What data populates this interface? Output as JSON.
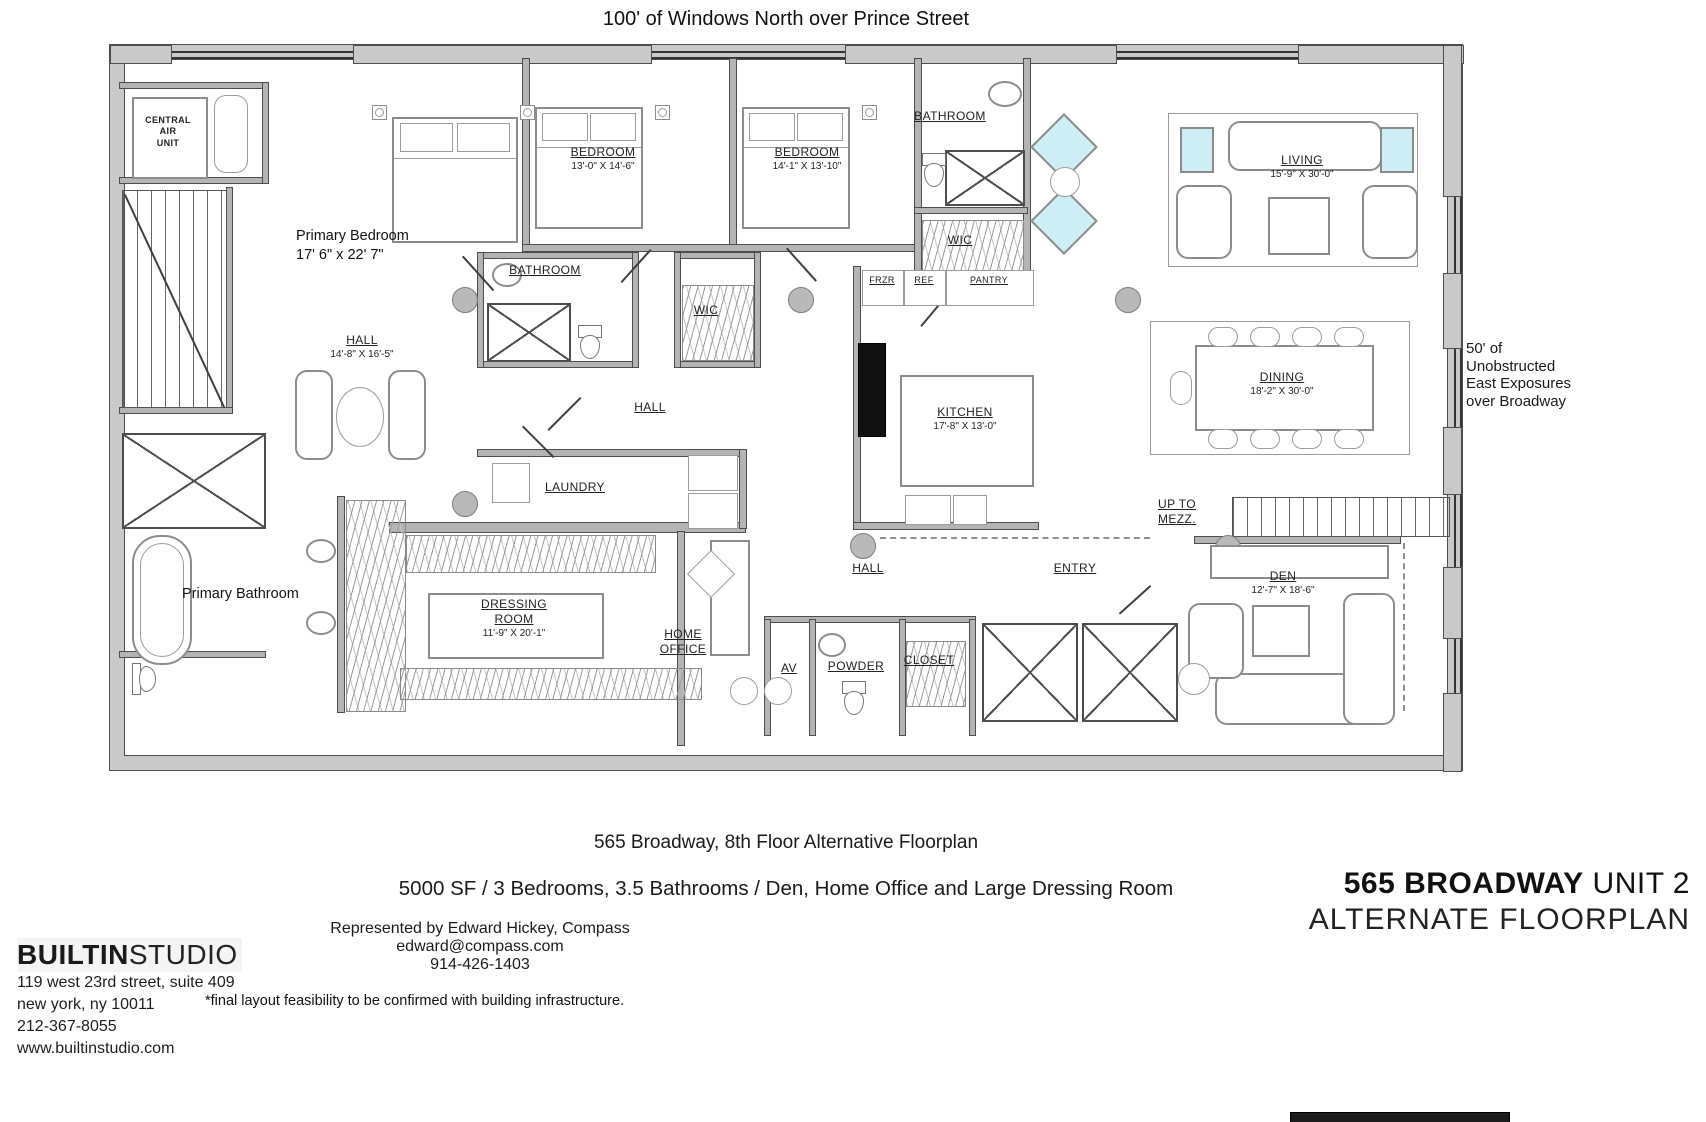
{
  "plan": {
    "title": "100' of Windows North over Prince Street",
    "side_note": "50' of Unobstructed East Exposures over Broadway"
  },
  "rooms": {
    "central_air": {
      "name": "CENTRAL\nAIR\nUNIT"
    },
    "primary_bedroom": {
      "name": "Primary Bedroom",
      "dims": "17' 6\" x 22' 7\""
    },
    "bedroom_2": {
      "name": "BEDROOM",
      "dims": "13'-0\" X 14'-6\""
    },
    "bedroom_3": {
      "name": "BEDROOM",
      "dims": "14'-1\" X 13'-10\""
    },
    "bathroom_hall": {
      "name": "BATHROOM"
    },
    "bathroom_top": {
      "name": "BATHROOM"
    },
    "wic_hall": {
      "name": "WIC"
    },
    "wic_top": {
      "name": "WIC"
    },
    "hall_primary": {
      "name": "HALL",
      "dims": "14'-8\" X 16'-5\""
    },
    "hall_center": {
      "name": "HALL"
    },
    "hall_rear": {
      "name": "HALL"
    },
    "frzr": {
      "name": "FRZR"
    },
    "ref": {
      "name": "REF"
    },
    "pantry": {
      "name": "PANTRY"
    },
    "kitchen": {
      "name": "KITCHEN",
      "dims": "17'-8\" X 13'-0\""
    },
    "living": {
      "name": "LIVING",
      "dims": "15'-9\" X 30'-0\""
    },
    "dining": {
      "name": "DINING",
      "dims": "18'-2\" X 30'-0\""
    },
    "laundry": {
      "name": "LAUNDRY"
    },
    "dressing_room": {
      "name": "DRESSING\nROOM",
      "dims": "11'-9\" X 20'-1\""
    },
    "home_office": {
      "name": "HOME\nOFFICE"
    },
    "av": {
      "name": "AV"
    },
    "powder": {
      "name": "POWDER"
    },
    "closet": {
      "name": "CLOSET"
    },
    "entry": {
      "name": "ENTRY"
    },
    "up_to_mezz": {
      "name": "UP TO\nMEZZ."
    },
    "den": {
      "name": "DEN",
      "dims": "12'-7\" X 18'-6\""
    },
    "primary_bathroom": {
      "name": "Primary Bathroom"
    }
  },
  "captions": {
    "line1": "565 Broadway, 8th Floor Alternative Floorplan",
    "line2": "5000 SF / 3 Bedrooms, 3.5 Bathrooms / Den, Home Office and Large Dressing Room"
  },
  "footer": {
    "studio": {
      "brand_bold": "BUILTIN",
      "brand_light": "STUDIO",
      "address1": "119 west 23rd street, suite 409",
      "address2": "new york, ny 10011",
      "phone": "212-367-8055",
      "website": "www.builtinstudio.com"
    },
    "agent": {
      "line1": "Represented by Edward Hickey, Compass",
      "email": "edward@compass.com",
      "phone": "914-426-1403"
    },
    "disclaimer": "*final layout feasibility to be confirmed with building infrastructure.",
    "title_block": {
      "line1_bold": "565 BROADWAY",
      "line1_light": " UNIT 2",
      "line2": "ALTERNATE FLOORPLAN"
    }
  },
  "colors": {
    "wall": "#c9c9c9",
    "accent": "#cdeef5",
    "line": "#4d4d4d"
  }
}
